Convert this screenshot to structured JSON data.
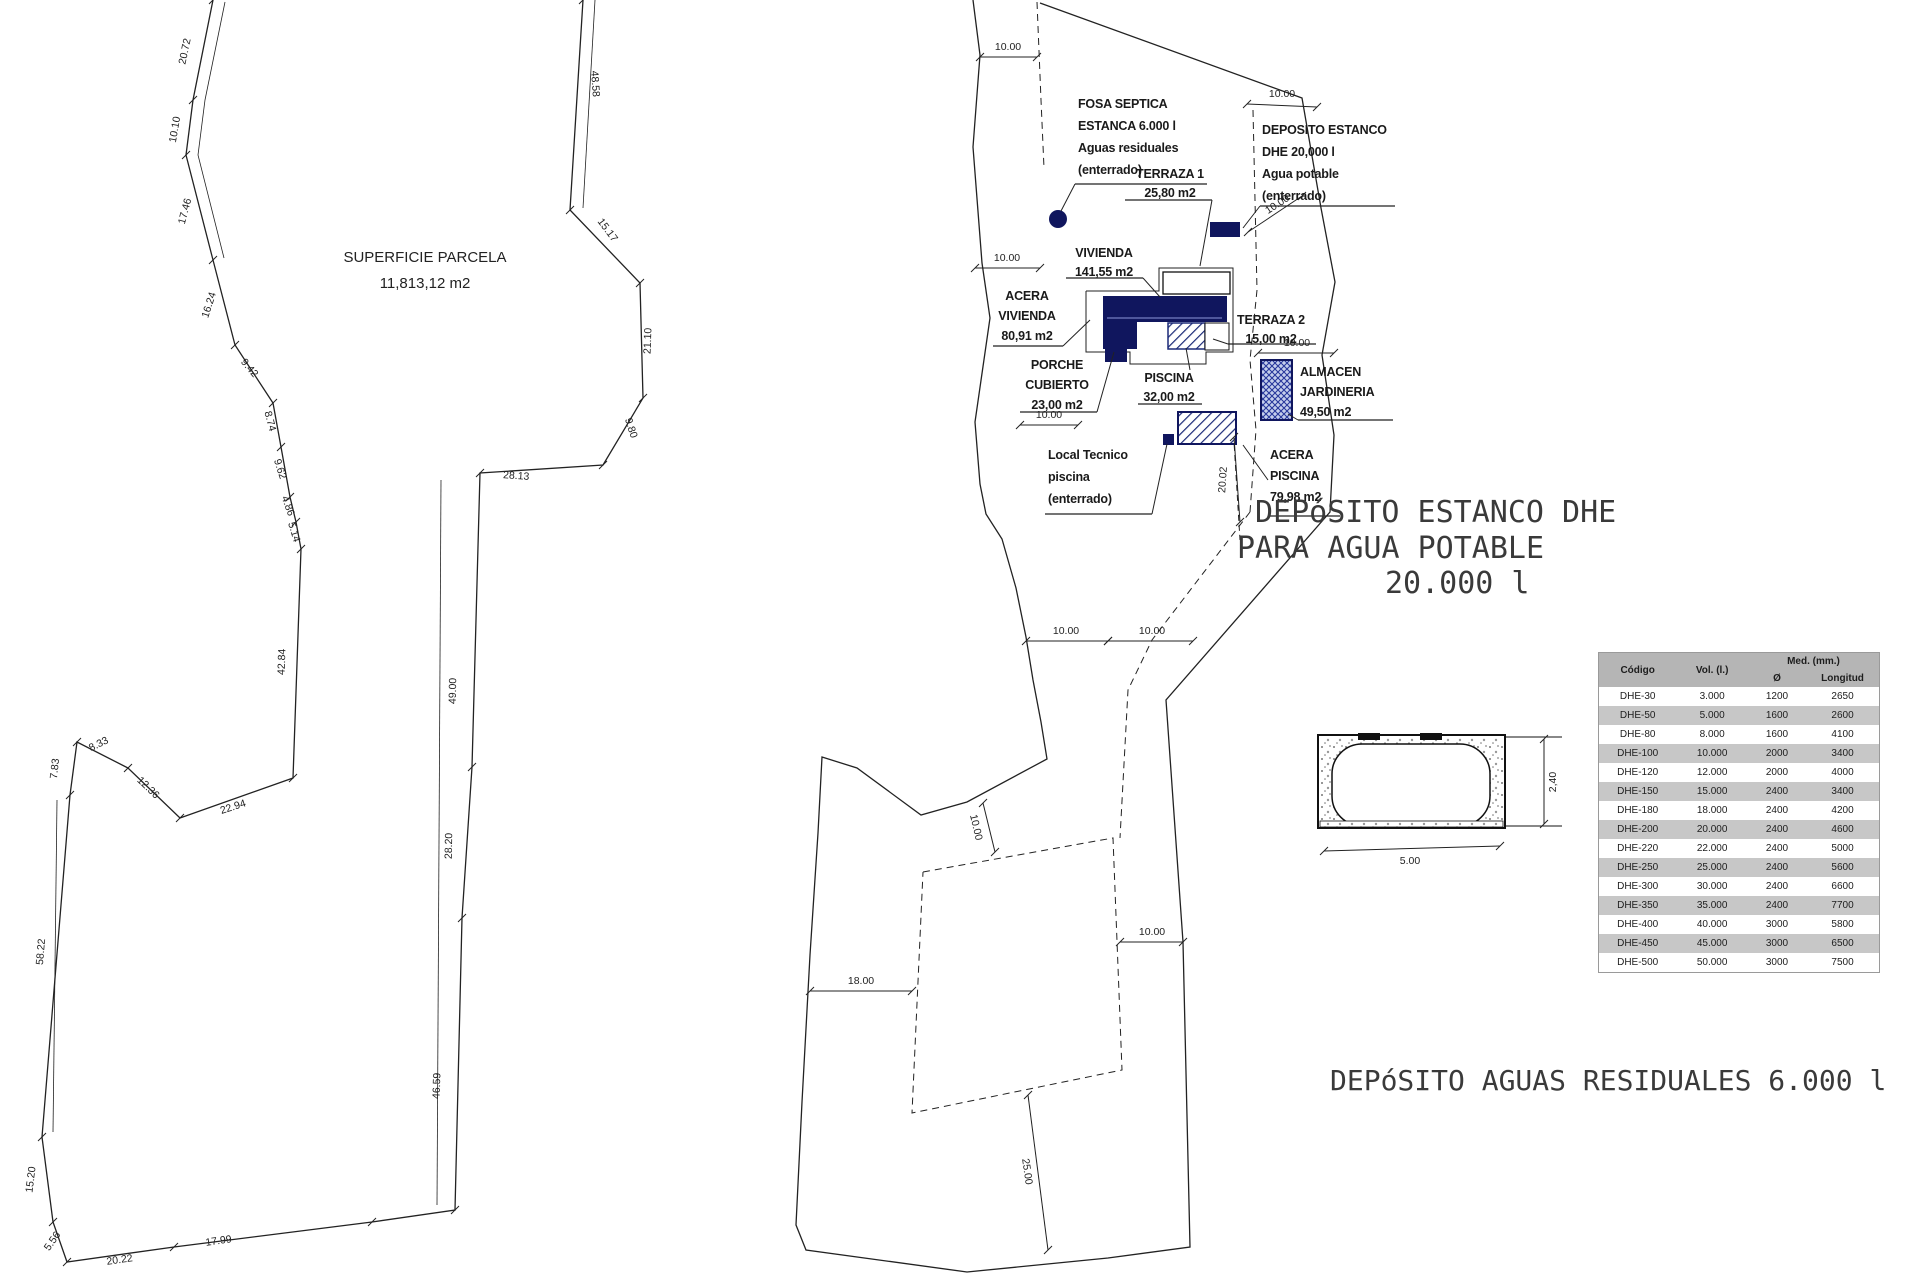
{
  "left_figure": {
    "area_label": {
      "line1": "SUPERFICIE PARCELA",
      "line2": "11,813,12 m2"
    },
    "polylines": [
      {
        "pts": "213,0 193,100 186,155 213,260 235,345 273,403 281,447 290,497 296,522 301,549 293,778 180,818 128,768 77,742 70,795 42,1137 53,1222 67,1262 174,1247 372,1222 455,1210 462,918 472,767 480,473 603,465 643,398 640,283 570,210 583,0",
        "w": 1.3,
        "ticks": true,
        "name": "parcel-boundary"
      },
      {
        "pts": "225,2 205,100 198,155 224,258",
        "w": 0.8,
        "name": "offset-dimension-line"
      },
      {
        "pts": "57,800 53,1132",
        "w": 0.8,
        "name": "offset-dimension-line"
      },
      {
        "pts": "595,0 583,208",
        "w": 0.8,
        "name": "offset-dimension-line"
      },
      {
        "pts": "441,480 437,1205",
        "w": 0.8,
        "name": "offset-dimension-line"
      }
    ],
    "dims": [
      {
        "t": "20.72",
        "x": 188,
        "y": 52,
        "r": -78
      },
      {
        "t": "10.10",
        "x": 178,
        "y": 130,
        "r": -80
      },
      {
        "t": "17.46",
        "x": 188,
        "y": 212,
        "r": -75
      },
      {
        "t": "16.24",
        "x": 212,
        "y": 306,
        "r": -72
      },
      {
        "t": "9.42",
        "x": 247,
        "y": 370,
        "r": 50
      },
      {
        "t": "8.74",
        "x": 267,
        "y": 422,
        "r": 75
      },
      {
        "t": "9.62",
        "x": 277,
        "y": 470,
        "r": 72
      },
      {
        "t": "4.86",
        "x": 285,
        "y": 507,
        "r": 70
      },
      {
        "t": "5.14",
        "x": 291,
        "y": 533,
        "r": 73
      },
      {
        "t": "42.84",
        "x": 285,
        "y": 662,
        "r": -88
      },
      {
        "t": "22.94",
        "x": 234,
        "y": 810,
        "r": -18
      },
      {
        "t": "12.36",
        "x": 146,
        "y": 790,
        "r": 44
      },
      {
        "t": "8.33",
        "x": 100,
        "y": 747,
        "r": -26
      },
      {
        "t": "7.83",
        "x": 58,
        "y": 769,
        "r": -84
      },
      {
        "t": "58.22",
        "x": 44,
        "y": 952,
        "r": -85
      },
      {
        "t": "15.20",
        "x": 34,
        "y": 1180,
        "r": -83
      },
      {
        "t": "5.56",
        "x": 55,
        "y": 1243,
        "r": -55
      },
      {
        "t": "20.22",
        "x": 120,
        "y": 1263,
        "r": -8
      },
      {
        "t": "17.99",
        "x": 219,
        "y": 1244,
        "r": -8
      },
      {
        "t": "28.13",
        "x": 516,
        "y": 479,
        "r": 4
      },
      {
        "t": "9.80",
        "x": 628,
        "y": 429,
        "r": 72
      },
      {
        "t": "21.10",
        "x": 651,
        "y": 341,
        "r": -88
      },
      {
        "t": "15.17",
        "x": 605,
        "y": 232,
        "r": 53
      },
      {
        "t": "48.58",
        "x": 592,
        "y": 84,
        "r": 86
      },
      {
        "t": "49.00",
        "x": 456,
        "y": 691,
        "r": -89
      },
      {
        "t": "28.20",
        "x": 452,
        "y": 846,
        "r": -89
      },
      {
        "t": "46.59",
        "x": 440,
        "y": 1086,
        "r": -88
      }
    ],
    "labels": [
      {
        "lines": [
          "SUPERFICIE PARCELA",
          "11,813,12 m2"
        ],
        "x": 425,
        "y": 262,
        "lh": 26,
        "cls": "big"
      }
    ]
  },
  "center_figure": {
    "polylines": [
      {
        "pts": "973,0 980,55 973,147 982,263 990,318 975,422 980,484 986,514 1002,539 1016,588 1026,637 1033,680 1041,722 1047,759 967,802 921,815 857,768 822,757 818,833 810,955 802,1102 796,1225 806,1250 967,1272 1108,1258 1190,1247 1183,942 1166,700 1330,512 1334,435 1322,355 1335,282 1321,208 1302,98 1040,3",
        "w": 1.3,
        "name": "plot-boundary"
      },
      {
        "pts": "1037,2 1041,100 1044,168",
        "dash": "7,5",
        "w": 1,
        "name": "setback-line"
      },
      {
        "pts": "1253,110 1257,290 1250,360 1256,430 1250,512",
        "dash": "7,5",
        "w": 1,
        "name": "setback-line"
      },
      {
        "pts": "1250,512 1152,640 1128,690 1120,838",
        "dash": "7,5",
        "w": 1,
        "name": "setback-line"
      },
      {
        "pts": "923,872 1113,838 1122,1070 912,1113 923,872",
        "dash": "7,5",
        "w": 1,
        "name": "setback-rectangle"
      },
      {
        "pts": "1233,425 1240,540",
        "dash": "6,4",
        "w": 1,
        "name": "setback-line"
      },
      {
        "pts": "1086,291 1159,291 1159,268 1233,268 1233,352 1206,352 1206,364 1130,364 1130,352 1086,352 1086,291",
        "w": 1,
        "name": "acera-outline"
      }
    ],
    "shapes": [
      {
        "t": "poly",
        "pts": "1102,296 1227,296 1227,322 1137,322 1137,349 1103,349 1103,296",
        "f": "navy",
        "name": "vivienda-footprint"
      },
      {
        "t": "line",
        "x1": 1107,
        "y1": 318,
        "x2": 1222,
        "y2": 318,
        "s": "#8d97d8",
        "sw": 1,
        "name": "vivienda-detail-line"
      },
      {
        "t": "rect",
        "x": 1105,
        "y": 349,
        "w": 22,
        "h": 13,
        "f": "navy",
        "name": "porche-footprint"
      },
      {
        "t": "rect",
        "x": 1168,
        "y": 323,
        "w": 37,
        "h": 26,
        "f": "hatch",
        "s": "#1b2a78",
        "sw": 1.5,
        "name": "piscina-footprint"
      },
      {
        "t": "rect",
        "x": 1205,
        "y": 323,
        "w": 24,
        "h": 27,
        "f": "white",
        "s": "#111",
        "sw": 1,
        "name": "terraza2-footprint"
      },
      {
        "t": "rect",
        "x": 1163,
        "y": 272,
        "w": 67,
        "h": 22,
        "f": "white",
        "s": "#111",
        "sw": 1.3,
        "name": "terraza1-footprint"
      },
      {
        "t": "rect",
        "x": 1261,
        "y": 360,
        "w": 31,
        "h": 60,
        "f": "cross",
        "s": "#10165e",
        "sw": 2,
        "name": "almacen-footprint"
      },
      {
        "t": "rect",
        "x": 1178,
        "y": 412,
        "w": 58,
        "h": 32,
        "f": "hatch",
        "s": "#10165e",
        "sw": 2,
        "name": "local-tecnico-footprint"
      },
      {
        "t": "rect",
        "x": 1163,
        "y": 434,
        "w": 11,
        "h": 11,
        "f": "navy",
        "name": "local-tecnico-marker"
      },
      {
        "t": "circle",
        "cx": 1058,
        "cy": 219,
        "r": 9,
        "f": "navy",
        "name": "fosa-septica-marker"
      },
      {
        "t": "rect",
        "x": 1210,
        "y": 222,
        "w": 30,
        "h": 15,
        "f": "navy",
        "name": "deposito-marker"
      }
    ],
    "dims": [
      {
        "l": [
          980,
          57,
          1037,
          57
        ],
        "t": "10.00",
        "x": 1008,
        "y": 50
      },
      {
        "l": [
          1247,
          104,
          1317,
          107
        ],
        "t": "10.00",
        "x": 1282,
        "y": 97
      },
      {
        "l": [
          975,
          268,
          1040,
          268
        ],
        "t": "10.00",
        "x": 1007,
        "y": 261
      },
      {
        "l": [
          1020,
          425,
          1078,
          425
        ],
        "t": "10.00",
        "x": 1049,
        "y": 418
      },
      {
        "l": [
          1248,
          232,
          1302,
          196
        ],
        "t": "10.00",
        "x": 1279,
        "y": 207,
        "r": -33
      },
      {
        "l": [
          1258,
          353,
          1334,
          353
        ],
        "t": "10.00",
        "x": 1297,
        "y": 346
      },
      {
        "l": [
          1026,
          641,
          1108,
          641
        ],
        "t": "10.00",
        "x": 1066,
        "y": 634
      },
      {
        "l": [
          1108,
          641,
          1193,
          641
        ],
        "t": "10.00",
        "x": 1152,
        "y": 634
      },
      {
        "l": [
          1120,
          942,
          1183,
          942
        ],
        "t": "10.00",
        "x": 1152,
        "y": 935
      },
      {
        "l": [
          983,
          803,
          995,
          852
        ],
        "t": "10.00",
        "x": 973,
        "y": 828,
        "r": 77
      },
      {
        "l": [
          810,
          991,
          912,
          991
        ],
        "t": "18.00",
        "x": 861,
        "y": 984
      },
      {
        "l": [
          1028,
          1095,
          1048,
          1250
        ],
        "t": "25.00",
        "x": 1024,
        "y": 1172,
        "r": 82
      },
      {
        "l": [
          1234,
          437,
          1240,
          522
        ],
        "t": "20.02",
        "x": 1226,
        "y": 480,
        "r": -86
      }
    ],
    "labels": [
      {
        "lines": [
          "FOSA SEPTICA",
          "ESTANCA 6.000 l",
          "Aguas residuales",
          "(enterrado)"
        ],
        "x": 1078,
        "y": 108,
        "lh": 22,
        "a": "start",
        "ul": [
          1075,
          1207,
          184
        ],
        "leader": "1075,184 1061,211"
      },
      {
        "lines": [
          "DEPOSITO ESTANCO",
          "DHE 20,000 l",
          "Agua potable",
          "(enterrado)"
        ],
        "x": 1262,
        "y": 134,
        "lh": 22,
        "a": "start",
        "ul": [
          1260,
          1395,
          206
        ],
        "leader": "1260,206 1243,228"
      },
      {
        "lines": [
          "TERRAZA 1",
          "25,80 m2"
        ],
        "x": 1170,
        "y": 178,
        "lh": 19,
        "ul": [
          1125,
          1212,
          200
        ],
        "leader": "1212,200 1200,266"
      },
      {
        "lines": [
          "VIVIENDA",
          "141,55 m2"
        ],
        "x": 1104,
        "y": 257,
        "lh": 19,
        "ul": [
          1066,
          1143,
          278
        ],
        "leader": "1143,278 1160,297"
      },
      {
        "lines": [
          "ACERA",
          "VIVIENDA",
          "80,91 m2"
        ],
        "x": 1027,
        "y": 300,
        "lh": 20,
        "ul": [
          993,
          1063,
          346
        ],
        "leader": "1063,346 1090,320"
      },
      {
        "lines": [
          "PORCHE",
          "CUBIERTO",
          "23,00 m2"
        ],
        "x": 1057,
        "y": 369,
        "lh": 20,
        "ul": [
          1020,
          1097,
          412
        ],
        "leader": "1097,412 1114,352"
      },
      {
        "lines": [
          "TERRAZA 2",
          "15,00 m2"
        ],
        "x": 1271,
        "y": 324,
        "lh": 19,
        "ul": [
          1228,
          1316,
          344
        ],
        "leader": "1228,344 1213,339"
      },
      {
        "lines": [
          "PISCINA",
          "32,00 m2"
        ],
        "x": 1169,
        "y": 382,
        "lh": 19,
        "ul": [
          1138,
          1202,
          404
        ],
        "leader": "1190,370 1186,348"
      },
      {
        "lines": [
          "ALMACEN",
          "JARDINERIA",
          "49,50 m2"
        ],
        "x": 1300,
        "y": 376,
        "lh": 20,
        "a": "start",
        "ul": [
          1298,
          1393,
          420
        ],
        "leader": "1298,420 1288,414"
      },
      {
        "lines": [
          "Local Tecnico",
          "piscina",
          "(enterrado)"
        ],
        "x": 1048,
        "y": 459,
        "lh": 22,
        "a": "start",
        "ul": [
          1045,
          1152,
          514
        ],
        "leader": "1152,514 1167,444"
      },
      {
        "lines": [
          "ACERA",
          "PISCINA",
          "79,98 m2"
        ],
        "x": 1270,
        "y": 459,
        "lh": 21,
        "a": "start",
        "ul": [
          1268,
          1340,
          516
        ],
        "leader": "1268,480 1243,445"
      }
    ]
  },
  "detail_figure": {
    "shapes": [
      {
        "t": "rect",
        "x": 1318,
        "y": 735,
        "w": 187,
        "h": 93,
        "f": "stip",
        "s": "#111",
        "sw": 2,
        "name": "concrete-pit"
      },
      {
        "t": "rect",
        "x": 1332,
        "y": 744,
        "w": 158,
        "h": 82,
        "rx": 30,
        "f": "white",
        "s": "#111",
        "sw": 1.5,
        "name": "tank-body"
      },
      {
        "t": "line",
        "x1": 1505,
        "y1": 737,
        "x2": 1562,
        "y2": 737,
        "s": "#111",
        "sw": 1,
        "name": "extension-line"
      },
      {
        "t": "line",
        "x1": 1505,
        "y1": 826,
        "x2": 1562,
        "y2": 826,
        "s": "#111",
        "sw": 1,
        "name": "extension-line"
      },
      {
        "t": "rect",
        "x": 1358,
        "y": 733,
        "w": 22,
        "h": 7,
        "f": "black",
        "name": "manhole-cover"
      },
      {
        "t": "rect",
        "x": 1420,
        "y": 733,
        "w": 22,
        "h": 7,
        "f": "black",
        "name": "manhole-cover"
      },
      {
        "t": "rect",
        "x": 1320,
        "y": 821,
        "w": 183,
        "h": 6,
        "f": "stip",
        "s": "#111",
        "sw": 0.8,
        "name": "base-slab"
      }
    ],
    "dims": [
      {
        "l": [
          1544,
          739,
          1544,
          824
        ],
        "t": "2,40",
        "x": 1556,
        "y": 782,
        "r": -90
      },
      {
        "l": [
          1324,
          851,
          1500,
          846
        ],
        "t": "5.00",
        "x": 1410,
        "y": 864
      }
    ],
    "labels": [
      {
        "lines": [
          "DEPóSITO ESTANCO DHE"
        ],
        "x": 1255,
        "y": 522,
        "a": "start",
        "cls": "cad"
      },
      {
        "lines": [
          "PARA AGUA POTABLE"
        ],
        "x": 1237,
        "y": 558,
        "a": "start",
        "cls": "cad"
      },
      {
        "lines": [
          "20.000 l"
        ],
        "x": 1385,
        "y": 593,
        "a": "start",
        "cls": "cad"
      },
      {
        "lines": [
          "DEPóSITO AGUAS RESIDUALES 6.000 l"
        ],
        "x": 1330,
        "y": 1090,
        "a": "start",
        "cls": "cad2"
      }
    ]
  },
  "table": {
    "header": {
      "codigo": "Código",
      "vol": "Vol. (l.)",
      "med": "Med. (mm.)",
      "diam": "Ø",
      "longitud": "Longitud"
    },
    "rows": [
      [
        "DHE-30",
        "3.000",
        "1200",
        "2650"
      ],
      [
        "DHE-50",
        "5.000",
        "1600",
        "2600"
      ],
      [
        "DHE-80",
        "8.000",
        "1600",
        "4100"
      ],
      [
        "DHE-100",
        "10.000",
        "2000",
        "3400"
      ],
      [
        "DHE-120",
        "12.000",
        "2000",
        "4000"
      ],
      [
        "DHE-150",
        "15.000",
        "2400",
        "3400"
      ],
      [
        "DHE-180",
        "18.000",
        "2400",
        "4200"
      ],
      [
        "DHE-200",
        "20.000",
        "2400",
        "4600"
      ],
      [
        "DHE-220",
        "22.000",
        "2400",
        "5000"
      ],
      [
        "DHE-250",
        "25.000",
        "2400",
        "5600"
      ],
      [
        "DHE-300",
        "30.000",
        "2400",
        "6600"
      ],
      [
        "DHE-350",
        "35.000",
        "2400",
        "7700"
      ],
      [
        "DHE-400",
        "40.000",
        "3000",
        "5800"
      ],
      [
        "DHE-450",
        "45.000",
        "3000",
        "6500"
      ],
      [
        "DHE-500",
        "50.000",
        "3000",
        "7500"
      ]
    ]
  },
  "colors": {
    "line": "#222222",
    "navy": "#10165e",
    "hatch_stroke": "#1b2a78",
    "cross_bg": "#c5cfec",
    "table_header_bg": "#b5b5b5",
    "table_shade_bg": "#c7c7c7"
  }
}
